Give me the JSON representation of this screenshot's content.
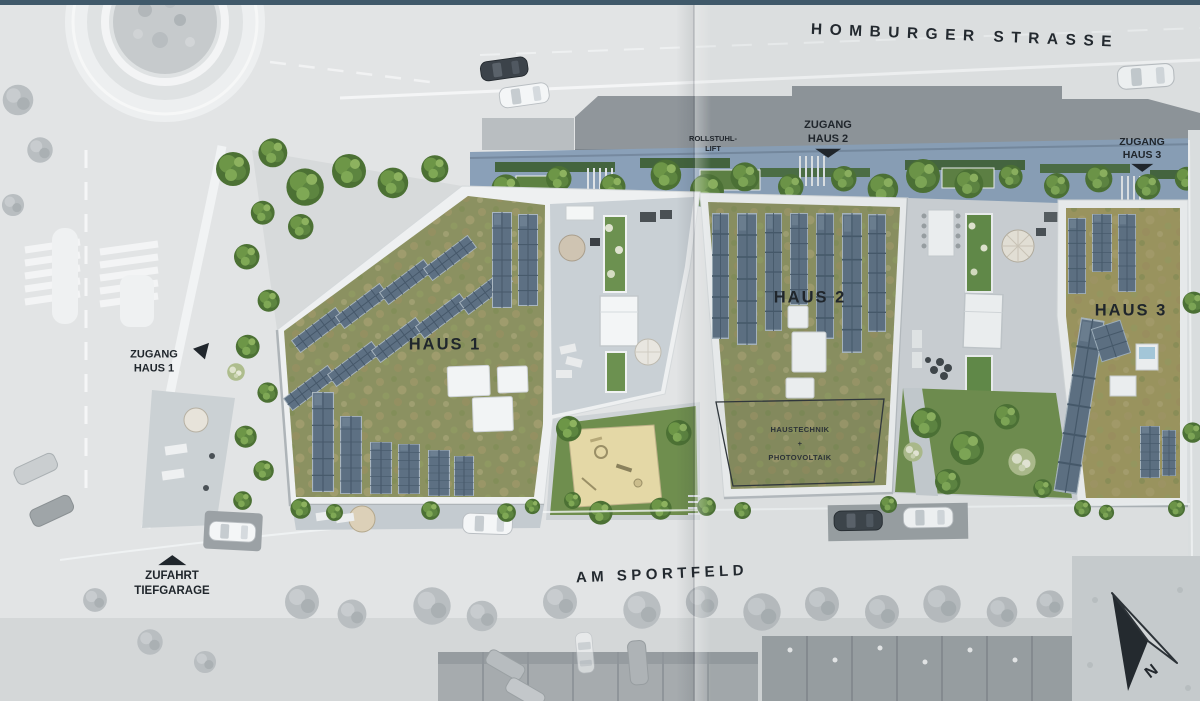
{
  "plan": {
    "streets": {
      "north": "HOMBURGER STRASSE",
      "south": "AM SPORTFELD"
    },
    "buildings": {
      "haus1": {
        "label": "HAUS 1"
      },
      "haus2": {
        "label": "HAUS 2",
        "roof_area": {
          "l1": "HAUSTECHNIK",
          "l2": "+",
          "l3": "PHOTOVOLTAIK"
        }
      },
      "haus3": {
        "label": "HAUS 3"
      }
    },
    "access": {
      "haus1": {
        "l1": "ZUGANG",
        "l2": "HAUS 1"
      },
      "haus2": {
        "l1": "ZUGANG",
        "l2": "HAUS 2"
      },
      "haus3": {
        "l1": "ZUGANG",
        "l2": "HAUS 3"
      },
      "lift": {
        "l1": "ROLLSTUHL-",
        "l2": "LIFT"
      },
      "garage": {
        "l1": "ZUFAHRT",
        "l2": "TIEFGARAGE"
      }
    },
    "compass": {
      "north": "N"
    },
    "palette": {
      "top_bar": "#40596a",
      "green_roof": "#8b9161",
      "green_roof_h3": "#a09a61",
      "solar_panel": "#5d7083",
      "walkway": "#8aa0b8",
      "street": "#e2e4e5",
      "lawn": "#6f8e4e",
      "sand": "#e4d8a6",
      "label": "#20262c"
    }
  }
}
